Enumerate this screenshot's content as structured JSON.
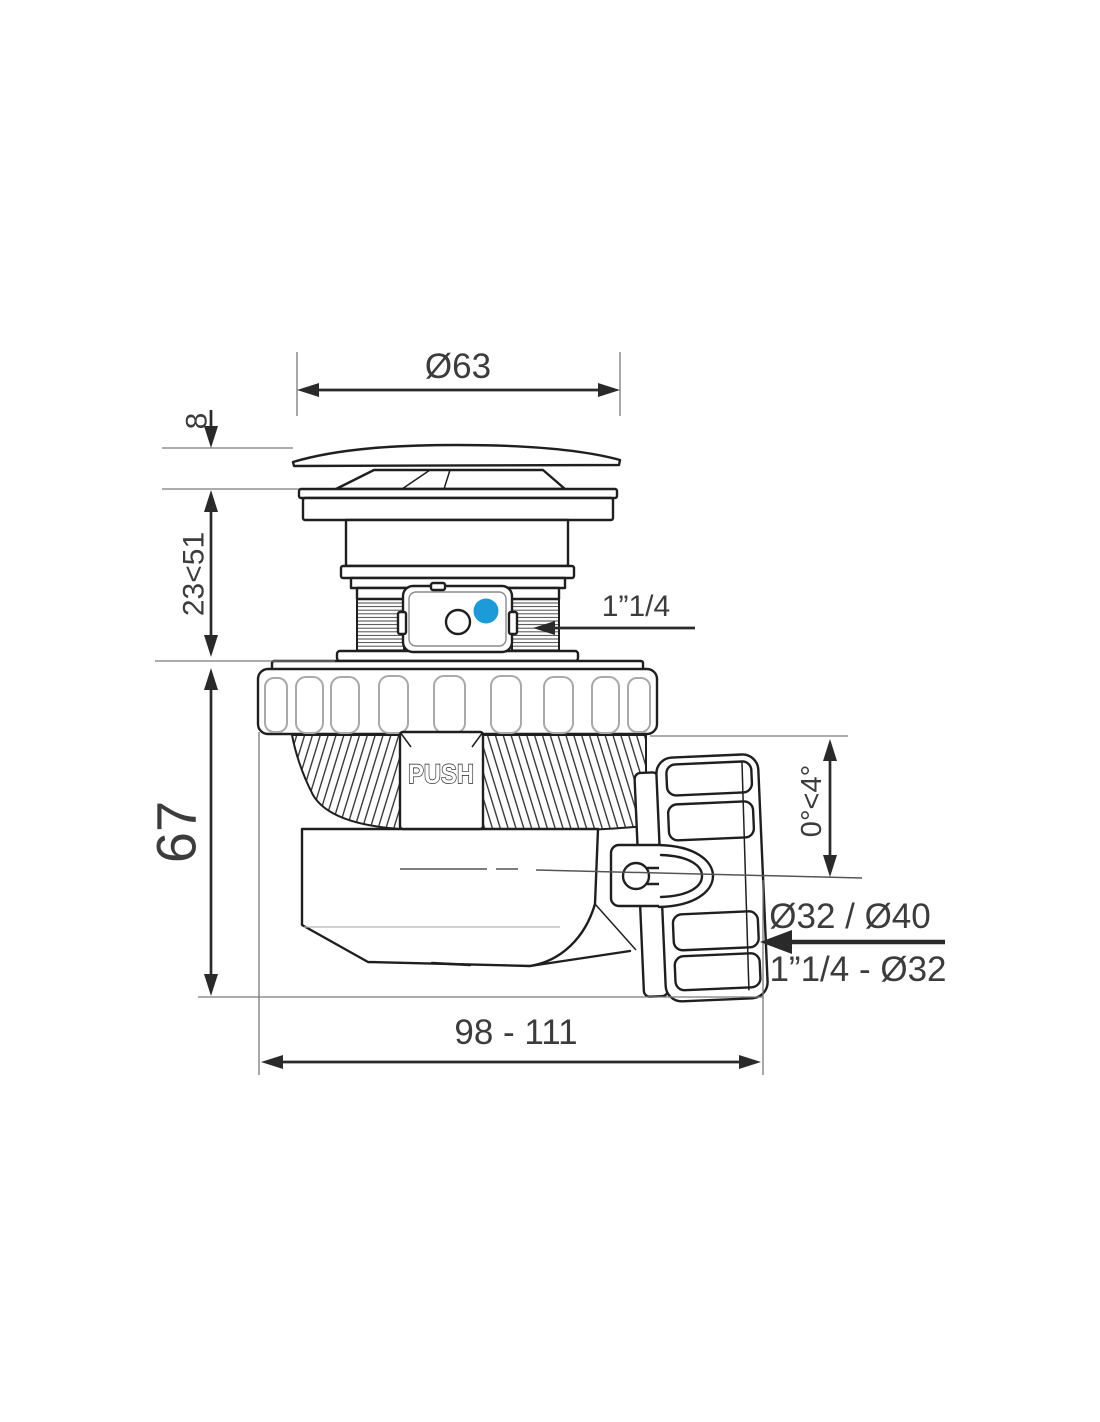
{
  "fixture": {
    "colors": {
      "indicator_blue": "#1d9bd8"
    },
    "dimensions": {
      "cap_diameter": "Ø63",
      "cap_thickness": "8",
      "adjustable_height": "23<51",
      "body_height": "67",
      "overall_length": "98 - 111",
      "tilt_angle": "0°<4°"
    },
    "connections": {
      "inlet_thread": "1”1/4",
      "outlet_diameters": "Ø32 / Ø40",
      "outlet_reduction": "1”1/4 - Ø32"
    },
    "button_label": "PUSH"
  }
}
